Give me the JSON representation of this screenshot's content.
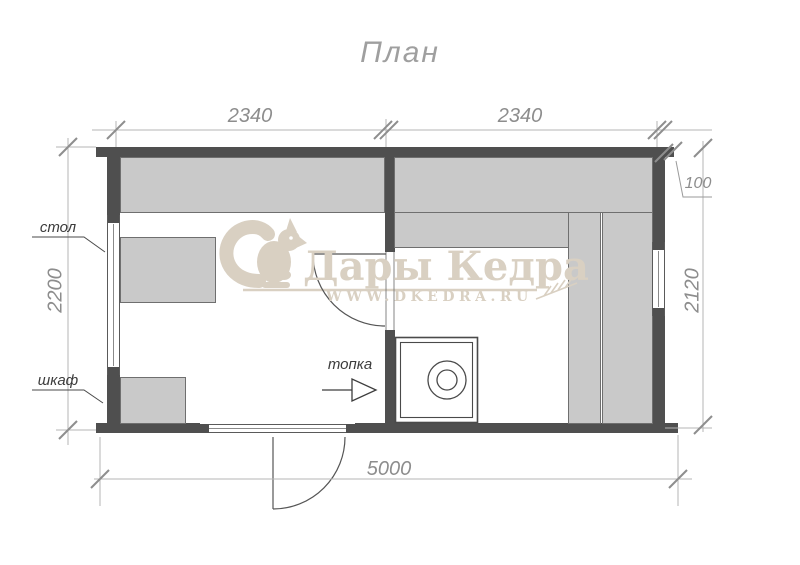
{
  "title": "План",
  "dimensions": {
    "left_room_width": "2340",
    "right_room_width": "2340",
    "roof_overhang": "100",
    "left_room_depth": "2200",
    "right_room_depth": "2120",
    "total_width": "5000"
  },
  "labels": {
    "table": "стол",
    "cabinet": "шкаф",
    "firebox": "топка"
  },
  "watermark": {
    "brand": "Дары Кедра",
    "website": "WWW.DKEDRA.RU"
  },
  "colors": {
    "wall": "#4f4f4f",
    "bench_fill": "#c9c9c9",
    "bench_outline": "#6f6f6f",
    "dimension_line": "#b5b5b5",
    "dimension_text": "#8d8d8d",
    "annotation_text": "#3b3b3b",
    "watermark": "#d9d0c2"
  }
}
